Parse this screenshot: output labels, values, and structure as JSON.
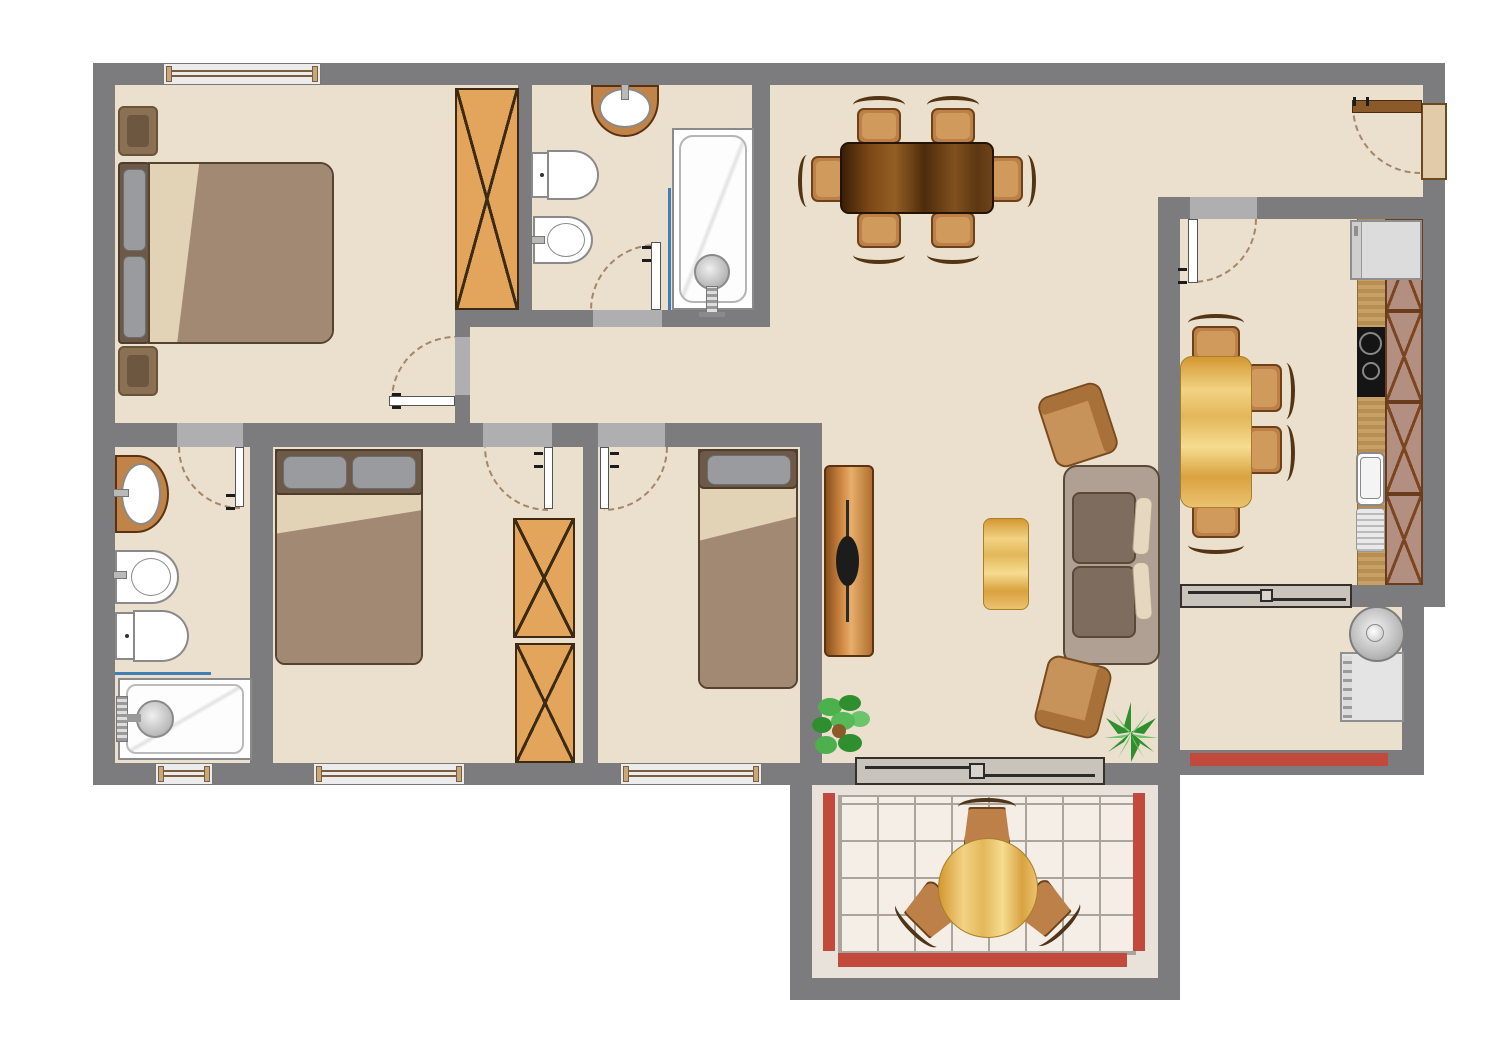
{
  "title": "apartment-floor-plan",
  "colors": {
    "wall": "#7C7C7F",
    "floor": "#EBDFCD",
    "lintel": "#AFAFB2",
    "winline": "#7A5C3E",
    "leaf": "#FFFFFF",
    "arc": "#A3876A",
    "wardrobe": "#E2A55B",
    "wardrobeLine": "#3C2B12",
    "cabinet": "#B28F80",
    "cabinetLine": "#7A4520",
    "chair": "#BC8048",
    "chairLine": "#6E4218",
    "headboard": "#6C5948",
    "pillow": "#9A9B9E",
    "sheet": "#E2D3B7",
    "blanket": "#A18974",
    "sofaBase": "#B0A093",
    "sofaCushion": "#7E6C5F",
    "sofaPillow": "#E6D8C0",
    "armchair": "#C8935B",
    "tile": "#F4EEE7",
    "grout": "#A9A49C",
    "railing": "#C24A3C",
    "fixtureLine": "#8A8A8A",
    "screenBlue": "#3F7FB5",
    "frontDoor": "#8B5A2B",
    "jamb": "#E2CBA8",
    "tv": "#1C1C1C",
    "appliance": "#DCDCDC",
    "plantDark": "#2F8F2F",
    "plantLight": "#6CC46C"
  },
  "rooms": [
    {
      "id": "master-bedroom",
      "furniture": [
        "double-bed",
        "nightstand",
        "nightstand",
        "wardrobe"
      ],
      "windows": 1,
      "doors": 1
    },
    {
      "id": "bathroom",
      "furniture": [
        "washbasin",
        "toilet",
        "bidet",
        "bathtub",
        "shower-screen"
      ],
      "doors": 1
    },
    {
      "id": "ensuite-bathroom",
      "furniture": [
        "washbasin",
        "bidet",
        "toilet",
        "shower-tray",
        "shower-screen"
      ],
      "windows": 1,
      "doors": 1
    },
    {
      "id": "bedroom-2",
      "furniture": [
        "double-bed",
        "wardrobe",
        "wardrobe"
      ],
      "windows": 1,
      "doors": 1
    },
    {
      "id": "bedroom-3",
      "furniture": [
        "single-bed"
      ],
      "windows": 1,
      "doors": 1
    },
    {
      "id": "hallway",
      "furniture": [],
      "doors": 0
    },
    {
      "id": "living-dining",
      "furniture": [
        "dining-table",
        "dining-chair",
        "dining-chair",
        "dining-chair",
        "dining-chair",
        "dining-chair",
        "dining-chair",
        "sofa",
        "armchair",
        "armchair",
        "coffee-table",
        "tv-stand",
        "plant",
        "plant"
      ],
      "doors": 1,
      "sliding_doors": 1
    },
    {
      "id": "entry",
      "furniture": [
        "front-door"
      ],
      "doors": 1
    },
    {
      "id": "kitchen",
      "furniture": [
        "kitchen-table",
        "chair",
        "chair",
        "chair",
        "chair",
        "counter",
        "cooktop",
        "sink",
        "cabinet-column",
        "refrigerator"
      ],
      "doors": 1,
      "sliding_doors": 1
    },
    {
      "id": "utility-balcony",
      "furniture": [
        "washing-machine"
      ],
      "railings": 1
    },
    {
      "id": "balcony",
      "furniture": [
        "round-table",
        "patio-chair",
        "patio-chair",
        "patio-chair"
      ],
      "railings": 3,
      "floor": "tiled"
    }
  ]
}
